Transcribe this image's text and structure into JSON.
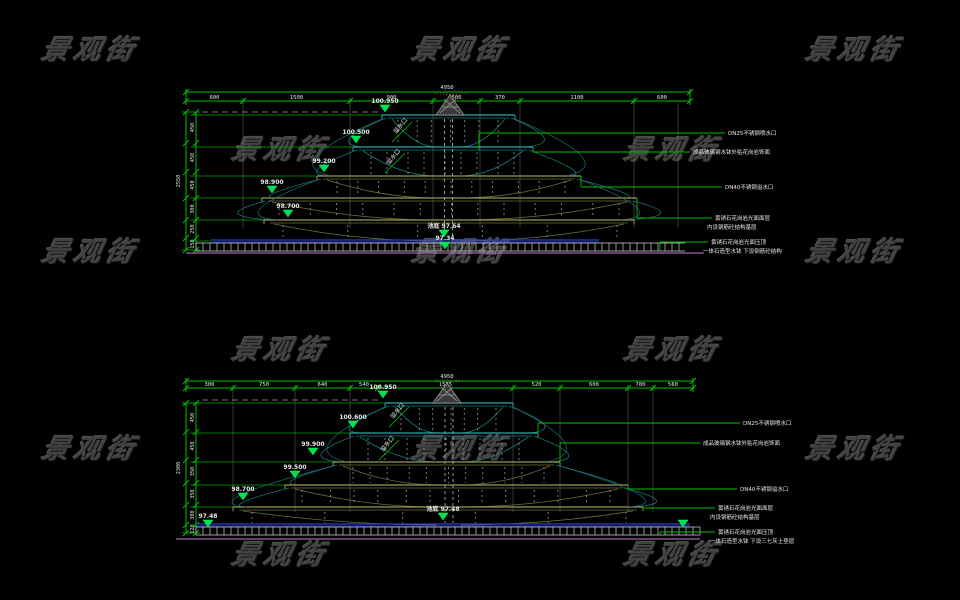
{
  "watermark": {
    "text": "景观街",
    "color": "#424242",
    "positions": [
      [
        98,
        46
      ],
      [
        468,
        46
      ],
      [
        862,
        46
      ],
      [
        288,
        146
      ],
      [
        680,
        146
      ],
      [
        98,
        248
      ],
      [
        468,
        248
      ],
      [
        862,
        248
      ],
      [
        288,
        346
      ],
      [
        680,
        346
      ],
      [
        98,
        445
      ],
      [
        468,
        445
      ],
      [
        862,
        445
      ],
      [
        288,
        551
      ],
      [
        680,
        551
      ]
    ]
  },
  "colors": {
    "dim_green": "#00c000",
    "marker_green": "#00e050",
    "teal": "#2fa8a8",
    "teal_dark": "#1e7d7d",
    "olive": "#9a9a55",
    "olive_dark": "#6e6e3e",
    "water_gray": "#8f8f8f",
    "hatch_white": "#cfcfcf",
    "pool_blue": "#2b3fd0",
    "base_magenta": "#c97fd0",
    "text_white": "#e8e8e8"
  },
  "drawings": [
    {
      "name": "fountain-elevation-top",
      "top_dims": {
        "total": "4950",
        "segments": [
          "600",
          "1500",
          "900",
          "500",
          "370",
          "1100",
          "600"
        ]
      },
      "left_dims": {
        "total": "2550",
        "segments": [
          "450",
          "450",
          "450",
          "300",
          "250",
          "150"
        ]
      },
      "elevation_markers": [
        "100.950",
        "100.500",
        "99.200",
        "98.900",
        "98.700",
        "池底 97.64",
        "97.34"
      ],
      "rotated_labels": [
        "溢水口",
        "溢水口"
      ],
      "leaders": [
        {
          "lines": [
            "DN25不锈钢喷水口"
          ]
        },
        {
          "lines": [
            "成品玻璃钢水钵外贴花岗岩饰面"
          ]
        },
        {
          "lines": [
            "DN40不锈钢溢水口"
          ]
        },
        {
          "lines": [
            "黄锈石花岗岩光面面层",
            "内设钢筋砼结构基层"
          ]
        },
        {
          "lines": [
            "黄锈石花岗岩光面压顶",
            "一体石造型水钵 下设钢筋砼结构"
          ]
        }
      ]
    },
    {
      "name": "fountain-elevation-bottom",
      "top_dims": {
        "total": "4950",
        "segments": [
          "300",
          "750",
          "640",
          "540",
          "1575",
          "520",
          "600",
          "700",
          "560"
        ]
      },
      "left_dims": {
        "total": "2300",
        "segments": [
          "450",
          "450",
          "350",
          "350",
          "300",
          "120"
        ]
      },
      "elevation_markers": [
        "100.950",
        "100.600",
        "99.900",
        "99.500",
        "98.700",
        "池底 97.48",
        "97.48",
        ""
      ],
      "rotated_labels": [
        "溢水口",
        "溢水口"
      ],
      "leaders": [
        {
          "lines": [
            "DN25不锈钢喷水口"
          ]
        },
        {
          "lines": [
            "成品玻璃钢水钵外贴花岗岩饰面"
          ]
        },
        {
          "lines": [
            "DN40不锈钢溢水口"
          ]
        },
        {
          "lines": [
            "黄锈石花岗岩光面面层",
            "内设钢筋砼结构基层"
          ]
        },
        {
          "lines": [
            "黄锈石花岗岩光面压顶",
            "一体石造型水钵 下设三七灰土垫层"
          ]
        }
      ]
    }
  ]
}
